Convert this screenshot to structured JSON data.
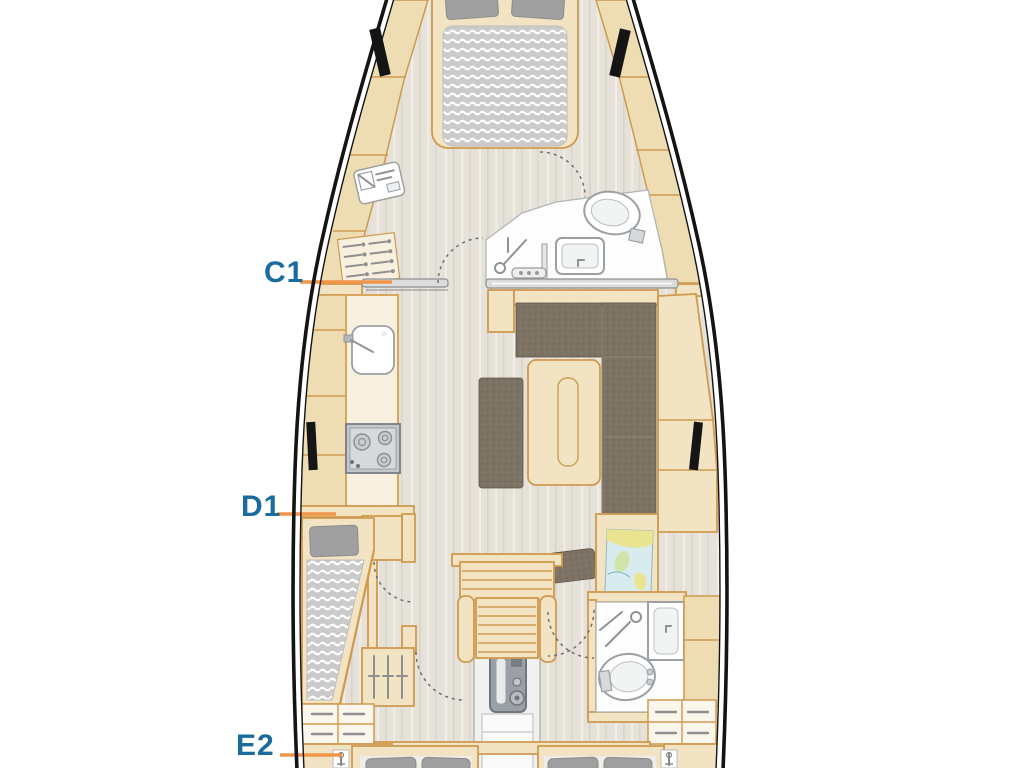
{
  "labels": {
    "c1": {
      "text": "C1"
    },
    "d1": {
      "text": "D1"
    },
    "e2": {
      "text": "E2"
    }
  },
  "colors": {
    "label_text": "#1a6b9e",
    "leader_line": "#f0964a",
    "hull_outline": "#141414",
    "wood_fill": "#f2e4c2",
    "wood_border": "#cf9a50",
    "shelf_fill": "#eedcb2",
    "counter_fill": "#f8f1e0",
    "sofa_leather": "#7c7365",
    "mattress_gray": "#cbcbcb",
    "pillow_gray": "#a0a0a0",
    "floor_beige": "#e6e2d9",
    "bathroom_white": "#fdfdfd",
    "engine_gray": "#9aa0a6",
    "window_black": "#151515",
    "chart_water": "#d8ecef",
    "chart_land": "#e9e48f"
  }
}
